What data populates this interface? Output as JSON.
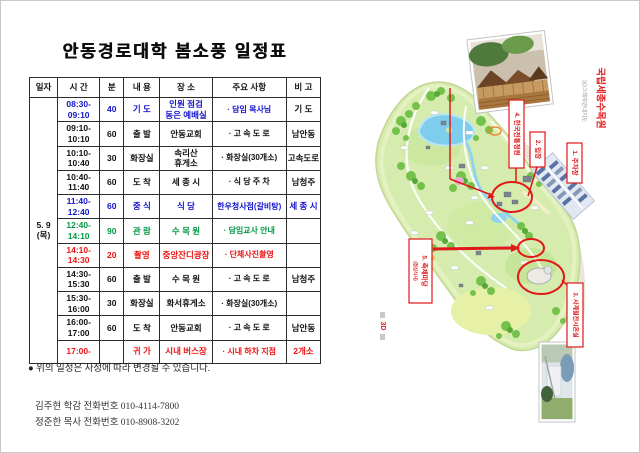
{
  "title": "안동경로대학 봄소풍 일정표",
  "schedule": {
    "headers": [
      "일자",
      "시 간",
      "분",
      "내 용",
      "장 소",
      "주요  사항",
      "비 고"
    ],
    "date_line1": "5. 9",
    "date_line2": "(목)",
    "rows": [
      {
        "time": "08:30-\n09:10",
        "min": "40",
        "what": "기 도",
        "where": "인원 점검\n동은 예배실",
        "detail": "· 담임 목사님",
        "note": "기 도",
        "color": "blue",
        "note_color": "black"
      },
      {
        "time": "09:10-\n10:10",
        "min": "60",
        "what": "출 발",
        "where": "안동교회",
        "detail": "· 고  속  도  로",
        "note": "남안동",
        "color": "black"
      },
      {
        "time": "10:10-\n10:40",
        "min": "30",
        "what": "화장실",
        "where": "속리산\n휴게소",
        "detail": "· 화장실(30개소)",
        "note": "고속도로",
        "color": "black"
      },
      {
        "time": "10:40-\n11:40",
        "min": "60",
        "what": "도 착",
        "where": "세 종 시",
        "detail": "· 식  당  주  차",
        "note": "남청주",
        "color": "black"
      },
      {
        "time": "11:40-\n12:40",
        "min": "60",
        "what": "중 식",
        "where": "식  당",
        "detail": "한우청사점(갈비탕)",
        "note": "세 종 시",
        "color": "blue"
      },
      {
        "time": "12:40-\n14:10",
        "min": "90",
        "what": "관 람",
        "where": "수 목 원",
        "detail": "· 담임교사 안내",
        "note": "",
        "color": "green"
      },
      {
        "time": "14:10-\n14:30",
        "min": "20",
        "what": "촬영",
        "where": "중앙잔디광장",
        "detail": "· 단체사진촬영",
        "note": "",
        "color": "red"
      },
      {
        "time": "14:30-\n15:30",
        "min": "60",
        "what": "출 발",
        "where": "수 목 원",
        "detail": "· 고  속  도  로",
        "note": "남청주",
        "color": "black"
      },
      {
        "time": "15:30-\n16:00",
        "min": "30",
        "what": "화장실",
        "where": "화서휴게소",
        "detail": "· 화장실(30개소)",
        "note": "",
        "color": "black"
      },
      {
        "time": "16:00-\n17:00",
        "min": "60",
        "what": "도 착",
        "where": "안동교회",
        "detail": "· 고  속  도  로",
        "note": "남안동",
        "color": "black"
      },
      {
        "time": "17:00-",
        "min": "",
        "what": "귀 가",
        "where": "시내 버스장",
        "detail": "· 시내  하차  지점",
        "note": "2개소",
        "color": "red"
      }
    ]
  },
  "footer": {
    "note": "● 위의 일정은 사정에 따라 변경될 수 있습니다.",
    "contact1": "김주현 학감 전화번호 010-4114-7800",
    "contact2": "정준한 목사 전화번호 010-8908-3202"
  },
  "map": {
    "title": "국립세종수목원",
    "subtitle": "3D그래픽안내지도",
    "logo": "3D",
    "labels": {
      "parking": "1. 주차장",
      "entrance": "2. 입장",
      "greenhouse": "3. 사계절전시온실",
      "garden": "4. 한국전통정원",
      "festival": "5. 축제마당",
      "festival_sub": "(점심식사)"
    }
  },
  "colors": {
    "text_blue": "#1414cc",
    "text_green": "#009944",
    "text_red": "#ee1111",
    "annotation_red": "#e01818",
    "map_green": "#d6ecae",
    "map_water": "#7ecdec"
  }
}
